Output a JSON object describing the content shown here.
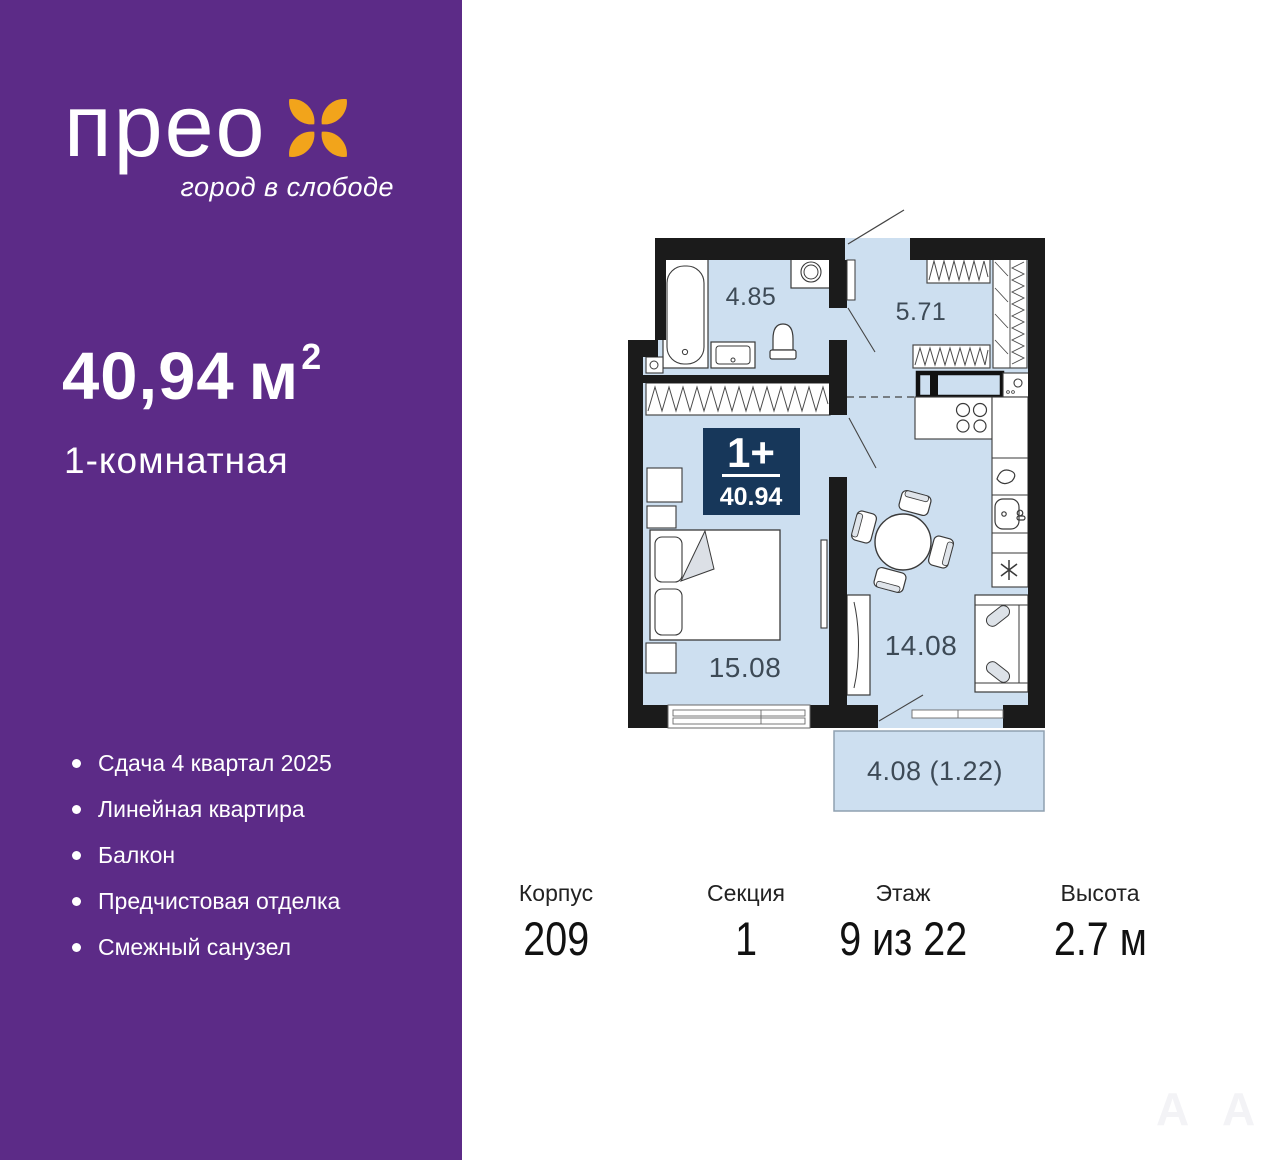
{
  "sidebar": {
    "logo": {
      "text": "прео",
      "tagline": "город в слободе"
    },
    "area": {
      "value": "40,94",
      "unit": "м",
      "sup": "2"
    },
    "apartment_type": "1-комнатная",
    "features": [
      "Сдача 4 квартал 2025",
      "Линейная квартира",
      "Балкон",
      "Предчистовая отделка",
      "Смежный санузел"
    ]
  },
  "plan": {
    "badge": {
      "rooms": "1+",
      "area": "40.94"
    },
    "rooms": {
      "bathroom": "4.85",
      "hallway": "5.71",
      "bedroom": "15.08",
      "living": "14.08",
      "balcony": "4.08 (1.22)"
    }
  },
  "specs": [
    {
      "label": "Корпус",
      "value": "209"
    },
    {
      "label": "Секция",
      "value": "1"
    },
    {
      "label": "Этаж",
      "value": "9 из 22"
    },
    {
      "label": "Высота",
      "value": "2.7 м"
    }
  ],
  "watermark": {
    "glyph": "A"
  },
  "colors": {
    "purple": "#5c2b87",
    "orange": "#f2a41b",
    "floor_blue": "#cddff0",
    "wall_black": "#1b1b1b",
    "badge_navy": "#17375a",
    "label_slate": "#3d4a56"
  }
}
